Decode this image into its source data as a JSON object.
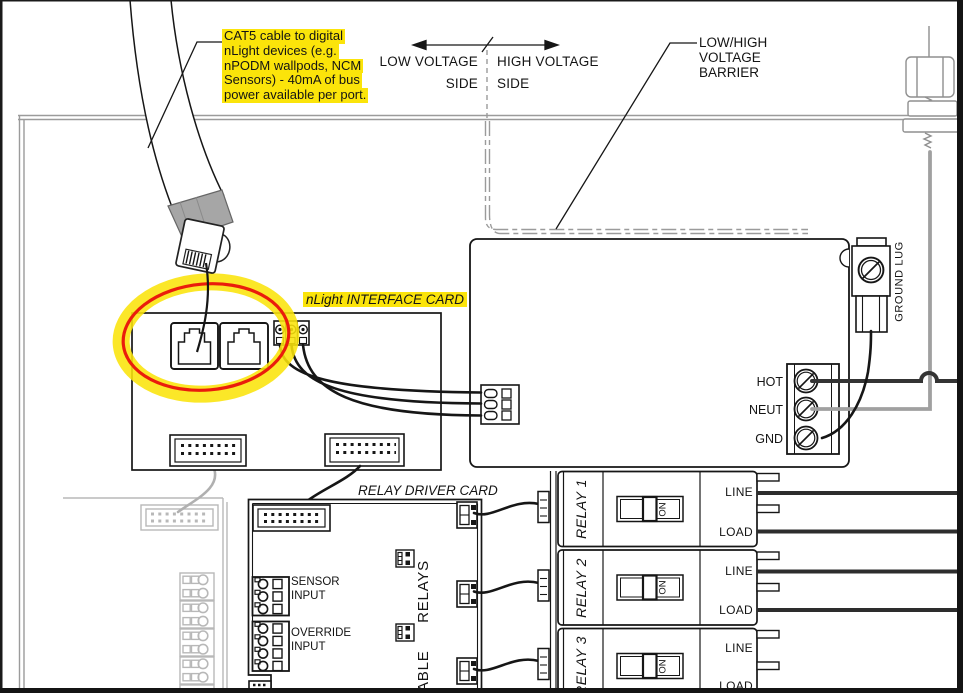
{
  "colors": {
    "highlight": "#fbe40a",
    "circle_red": "#ea1c0c"
  },
  "notes": {
    "cat5": {
      "lines": [
        "CAT5 cable to digital",
        "nLight devices (e.g.",
        "nPODM wallpods, NCM",
        "Sensors) - 40mA of bus",
        "power available per port."
      ]
    },
    "low_side": {
      "line1": "LOW VOLTAGE",
      "line2": "SIDE"
    },
    "high_side": {
      "line1": "HIGH VOLTAGE",
      "line2": "SIDE"
    },
    "barrier": {
      "line1": "LOW/HIGH",
      "line2": "VOLTAGE",
      "line3": "BARRIER"
    }
  },
  "interface_card": {
    "title": "nLight INTERFACE CARD"
  },
  "driver_card": {
    "title": "RELAY DRIVER CARD",
    "sensor_line1": "SENSOR",
    "sensor_line2": "INPUT",
    "override_line1": "OVERRIDE",
    "override_line2": "INPUT",
    "vert_word1": "ABLE",
    "vert_word2": "RELAYS"
  },
  "power": {
    "hot": "HOT",
    "neut": "NEUT",
    "gnd": "GND",
    "ground_lug": "GROUND LUG"
  },
  "relays": [
    {
      "name": "RELAY 1",
      "sw": "ON",
      "line": "LINE",
      "load": "LOAD"
    },
    {
      "name": "RELAY 2",
      "sw": "ON",
      "line": "LINE",
      "load": "LOAD"
    },
    {
      "name": "RELAY 3",
      "sw": "ON",
      "line": "LINE",
      "load": "LOAD"
    }
  ]
}
